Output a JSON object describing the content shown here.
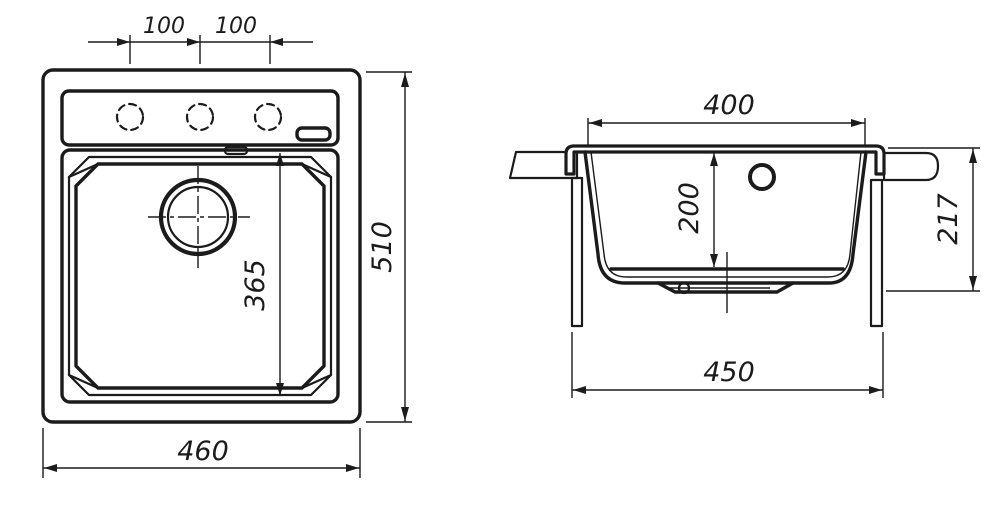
{
  "colors": {
    "ink": "#1b1b1b",
    "paper": "#ffffff"
  },
  "top_view": {
    "dims": {
      "faucet_pitch_left": "100",
      "faucet_pitch_right": "100",
      "overall_width": "460",
      "overall_depth": "510",
      "bowl_length": "365"
    }
  },
  "section_view": {
    "dims": {
      "bowl_top_width": "400",
      "bowl_inner_depth": "200",
      "overall_height": "217",
      "cabinet_min_width": "450"
    }
  }
}
